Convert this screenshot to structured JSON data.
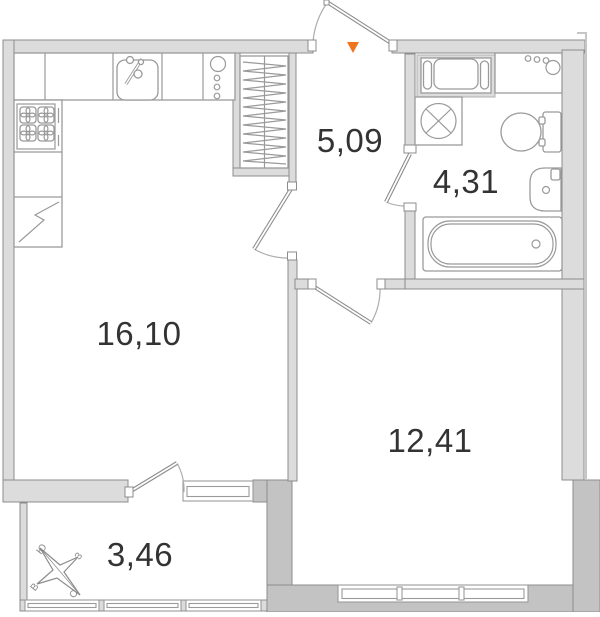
{
  "plan": {
    "title": "one-room apartment floor plan",
    "rooms": [
      {
        "id": "kitchen-living-room",
        "area_label": "16,10"
      },
      {
        "id": "hallway",
        "area_label": "5,09"
      },
      {
        "id": "bathroom",
        "area_label": "4,31"
      },
      {
        "id": "bedroom",
        "area_label": "12,41"
      },
      {
        "id": "balcony",
        "area_label": "3,46"
      }
    ],
    "compass": {
      "north_label": "С",
      "south_label": "Ю",
      "west_label": "З",
      "east_label": "В"
    },
    "icons": [
      "entrance-arrow-icon",
      "kitchen-sink-icon",
      "stove-icon",
      "refrigerator-icon",
      "water-heater-cabinet-icon",
      "wardrobe-icon",
      "laundry-appliance-icon",
      "vanity-counter-icon",
      "washing-machine-icon",
      "toilet-icon",
      "washbasin-icon",
      "bathtub-icon",
      "compass-rose-icon"
    ],
    "colors": {
      "wall_light": "#dcdcdc",
      "wall_dark": "#c3c3c3",
      "outline": "#8c8c8c",
      "fixture": "#9a9a9a",
      "text": "#333333",
      "entrance_marker": "#f0731d"
    }
  }
}
